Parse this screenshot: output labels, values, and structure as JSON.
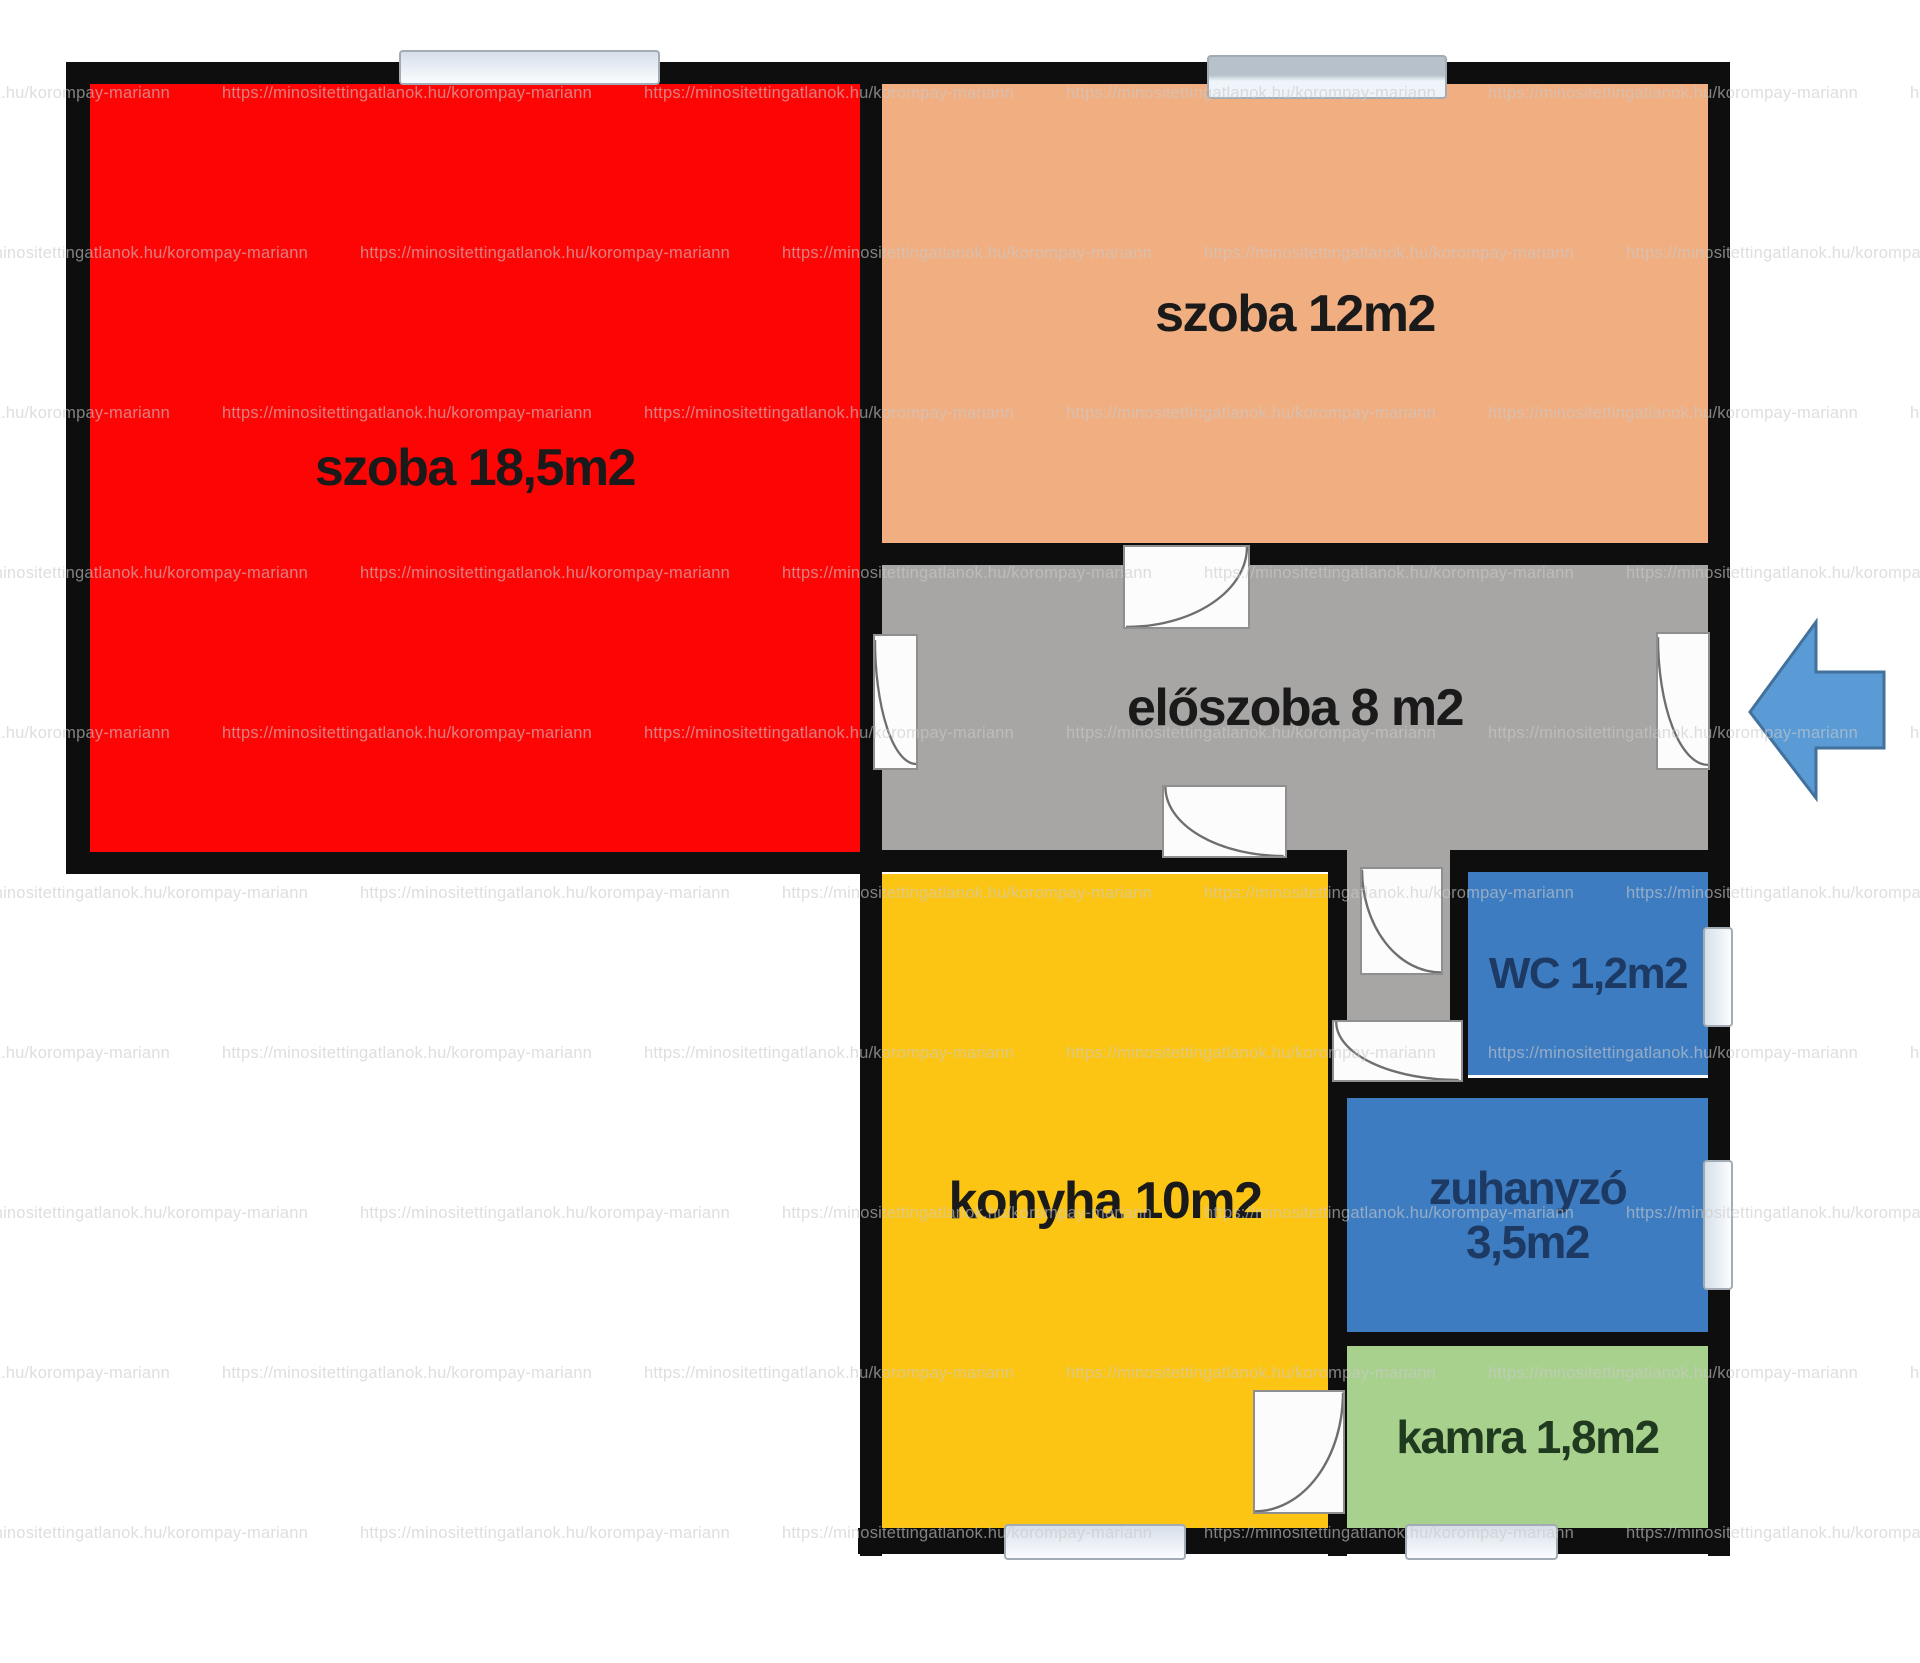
{
  "watermark": {
    "text": "https://minositettingatlanok.hu/korompay-mariann"
  },
  "rooms": {
    "szoba185": {
      "name": "szoba",
      "area": "18,5m2",
      "label": "szoba 18,5m2"
    },
    "szoba12": {
      "name": "szoba",
      "area": "12m2",
      "label": "szoba 12m2"
    },
    "eloszoba": {
      "name": "előszoba",
      "area": "8 m2",
      "label": "előszoba 8 m2"
    },
    "konyha": {
      "name": "konyha",
      "area": "10m2",
      "label": "konyha 10m2"
    },
    "wc": {
      "name": "WC",
      "area": "1,2m2",
      "label": "WC 1,2m2"
    },
    "zuhanyzo": {
      "name": "zuhanyzó",
      "area": "3,5m2"
    },
    "kamra": {
      "name": "kamra",
      "area": "1,8m2",
      "label": "kamra 1,8m2"
    }
  },
  "colors": {
    "wall": "#0e0e0e",
    "room_szoba185": "#fe0505",
    "room_szoba12": "#f1ae80",
    "room_eloszoba": "#a8a6a4",
    "room_konyha": "#fdc513",
    "room_wc": "#3e7cc1",
    "room_zuhanyzo": "#3e7cc1",
    "room_kamra": "#a9d18e",
    "label_dark": "#1a1a1a",
    "label_blue": "#1c3a63",
    "label_green": "#203a20",
    "door_fill": "#fcfcfc",
    "arrow_fill": "#5b9bd5",
    "arrow_stroke": "#41719c"
  },
  "icons": {
    "entrance_arrow": "left-block-arrow",
    "door": "quarter-arc-door-swing",
    "window": "wall-window-bar"
  }
}
